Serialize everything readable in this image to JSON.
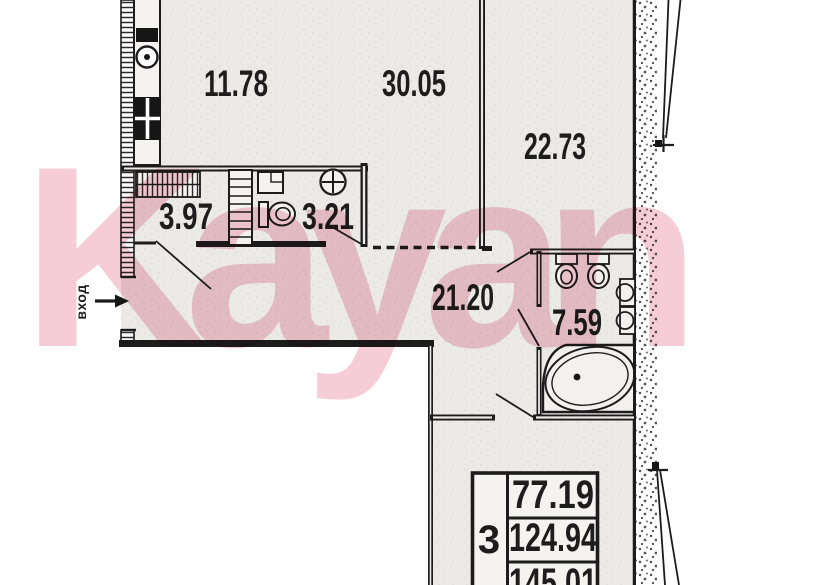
{
  "watermark": {
    "text": "Kayan",
    "color": "#f6ccd7"
  },
  "entrance": {
    "label": "вход"
  },
  "rooms": {
    "kitchen_area": "11.78",
    "living_area": "30.05",
    "bedroom_area": "22.73",
    "closet_area": "3.97",
    "wc_area": "3.21",
    "hall_area": "21.20",
    "bathroom_area": "7.59"
  },
  "summary_table": {
    "rooms_count": "3",
    "living_total": "77.19",
    "area_total": "124.94",
    "area_with_balcony": "145.01"
  },
  "colors": {
    "line": "#1c1c1c",
    "floor_fill": "#ebeae6"
  }
}
